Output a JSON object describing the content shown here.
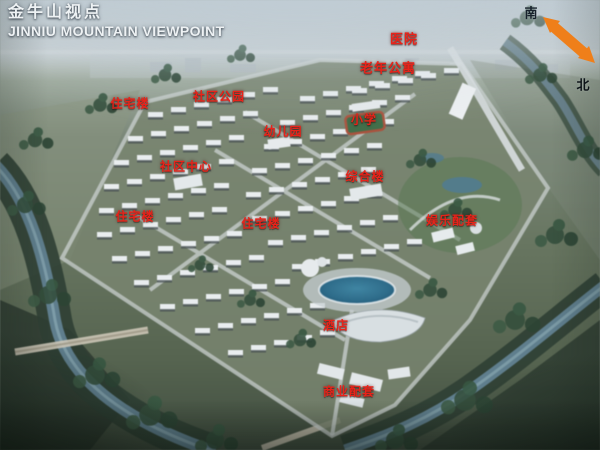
{
  "header": {
    "title_cn": "金牛山视点",
    "title_en": "JINNIU MOUNTAIN VIEWPOINT"
  },
  "compass": {
    "south": "南",
    "north": "北",
    "arrow_color": "#ef7f1a"
  },
  "map_labels": [
    {
      "id": "hospital",
      "text": "医院"
    },
    {
      "id": "senior-apartments",
      "text": "老年公寓"
    },
    {
      "id": "residential-a",
      "text": "住宅楼"
    },
    {
      "id": "community-park",
      "text": "社区公园"
    },
    {
      "id": "kindergarten",
      "text": "幼儿园"
    },
    {
      "id": "primary-school",
      "text": "小学"
    },
    {
      "id": "community-center",
      "text": "社区中心"
    },
    {
      "id": "mixed-use-building",
      "text": "综合楼"
    },
    {
      "id": "residential-b",
      "text": "住宅楼"
    },
    {
      "id": "residential-c",
      "text": "住宅楼"
    },
    {
      "id": "entertainment-amenities",
      "text": "娱乐配套"
    },
    {
      "id": "hotel",
      "text": "酒店"
    },
    {
      "id": "commercial-amenities",
      "text": "商业配套"
    }
  ],
  "colors": {
    "label_red": "#e8231a",
    "arrow_orange": "#ef7f1a",
    "title_white": "#eef2f4"
  }
}
